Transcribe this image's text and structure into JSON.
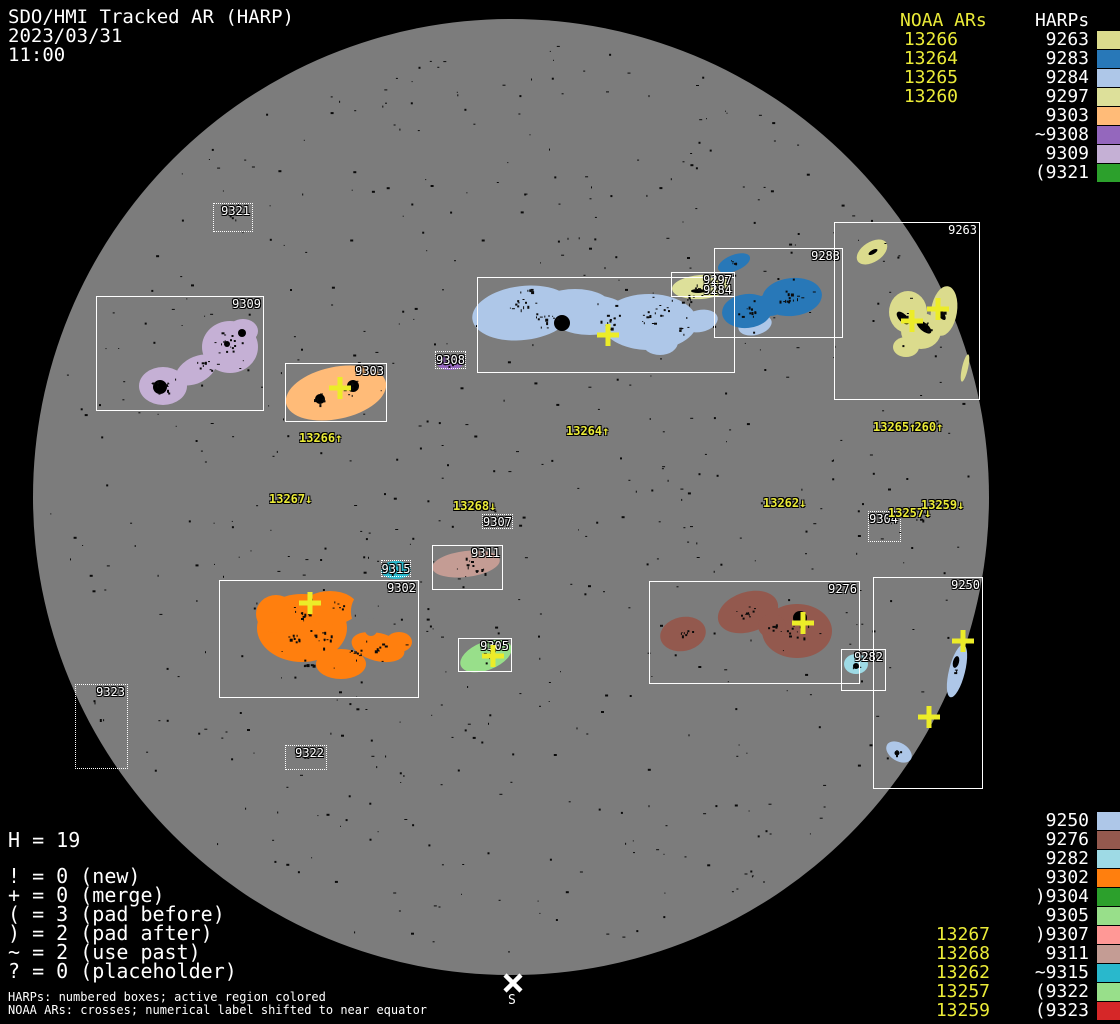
{
  "header": {
    "title": "SDO/HMI Tracked AR (HARP)",
    "date": "2023/03/31",
    "time": "11:00"
  },
  "top_legend": {
    "noaa_header": "NOAA ARs",
    "harps_header": "HARPs",
    "rows": [
      {
        "noaa": "13266",
        "harp": "9263",
        "color": "#dbdb8d"
      },
      {
        "noaa": "13264",
        "harp": "9283",
        "color": "#2878b8"
      },
      {
        "noaa": "13265",
        "harp": "9284",
        "color": "#aec7e8"
      },
      {
        "noaa": "13260",
        "harp": "9297",
        "color": "#dde09a"
      },
      {
        "noaa": "",
        "harp": "9303",
        "color": "#ffbb78"
      },
      {
        "noaa": "",
        "harp": "~9308",
        "color": "#9467bd"
      },
      {
        "noaa": "",
        "harp": "9309",
        "color": "#c5b0d5"
      },
      {
        "noaa": "",
        "harp": "(9321",
        "color": "#2ca02c"
      }
    ]
  },
  "bottom_legend": {
    "rows": [
      {
        "noaa": "",
        "harp": "9250",
        "color": "#aec7e8"
      },
      {
        "noaa": "",
        "harp": "9276",
        "color": "#93594e"
      },
      {
        "noaa": "",
        "harp": "9282",
        "color": "#9edae5"
      },
      {
        "noaa": "",
        "harp": "9302",
        "color": "#ff7f0e"
      },
      {
        "noaa": "",
        "harp": ")9304",
        "color": "#2ca02c"
      },
      {
        "noaa": "",
        "harp": "9305",
        "color": "#98df8a"
      },
      {
        "noaa": "13267",
        "harp": ")9307",
        "color": "#ff9896"
      },
      {
        "noaa": "13268",
        "harp": "9311",
        "color": "#c49c94"
      },
      {
        "noaa": "13262",
        "harp": "~9315",
        "color": "#29b8cc"
      },
      {
        "noaa": "13257",
        "harp": "(9322",
        "color": "#98df8a"
      },
      {
        "noaa": "13259",
        "harp": "(9323",
        "color": "#d62728"
      }
    ]
  },
  "stats": {
    "harp_count": "H = 19",
    "flags": [
      "! = 0 (new)",
      "+ = 0 (merge)",
      "( = 3 (pad before)",
      ") = 2 (pad after)",
      "~ = 2 (use past)",
      "? = 0 (placeholder)"
    ]
  },
  "footer": {
    "line1": "HARPs: numbered boxes; active region colored",
    "line2": "NOAA ARs: crosses; numerical label shifted to near equator"
  },
  "disk": {
    "box_labels": [
      "9321",
      "9309",
      "9303",
      "9308",
      "9284",
      "9297",
      "9283",
      "9263",
      "9304",
      "9307",
      "9311",
      "9315",
      "9302",
      "9305",
      "9276",
      "9282",
      "9250",
      "9322",
      "9323"
    ],
    "noaa_labels": [
      "13266↑",
      "13264↑",
      "13265↑",
      "13260↑",
      "13267↓",
      "13268↓",
      "13262↓",
      "13257↓",
      "13259↓"
    ],
    "south_label": "S"
  },
  "colors": {
    "noaa_yellow": "#ebeb38",
    "cross_yellow": "#ecec28",
    "disk_gray": "#7c7c7c",
    "box_border": "#ffffff",
    "background": "#000000"
  }
}
